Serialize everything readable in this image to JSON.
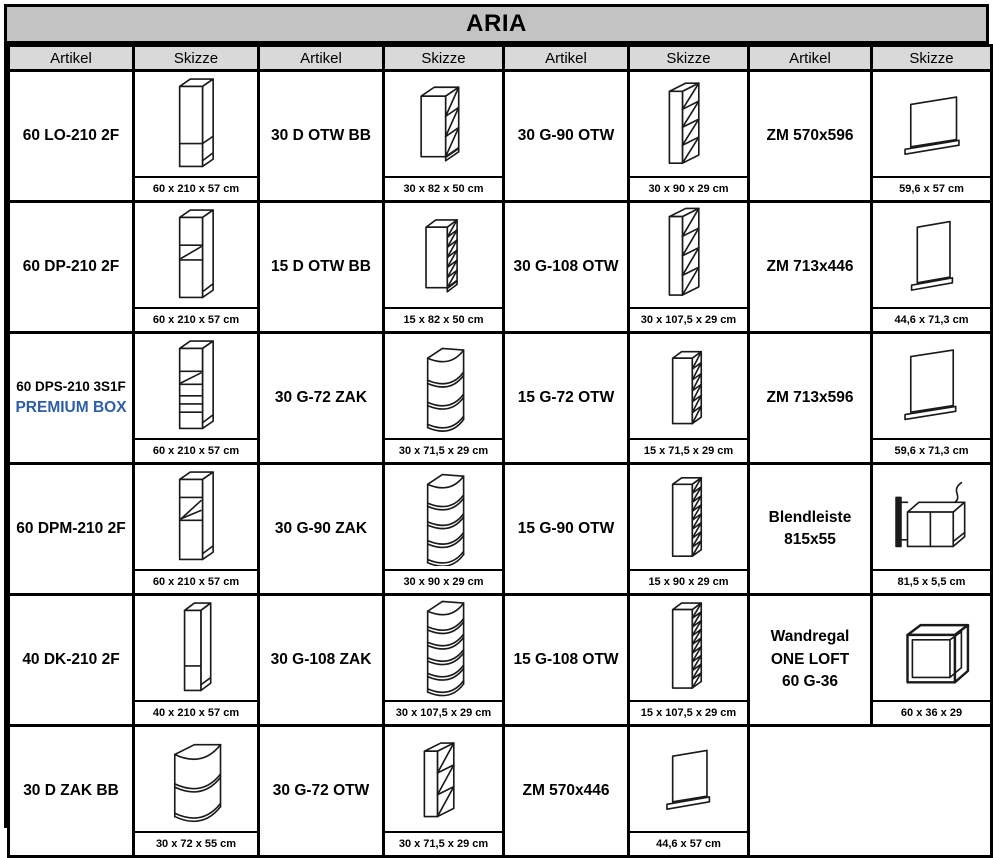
{
  "title": "ARIA",
  "column_headers": [
    "Artikel",
    "Skizze",
    "Artikel",
    "Skizze",
    "Artikel",
    "Skizze",
    "Artikel",
    "Skizze"
  ],
  "colors": {
    "title_bg": "#C3C3C3",
    "subheader_bg": "#D9D9D9",
    "border": "#000000",
    "premium_blue": "#2E5EA6"
  },
  "rows": [
    [
      {
        "artikel_lines": [
          "60 LO-210 2F"
        ],
        "sketch": "tall-cabinet-2f",
        "dim": "60 x 210 x 57 cm"
      },
      {
        "artikel_lines": [
          "30 D OTW BB"
        ],
        "sketch": "base-open-shelf-30",
        "dim": "30 x 82 x 50 cm"
      },
      {
        "artikel_lines": [
          "30 G-90 OTW"
        ],
        "sketch": "wall-open-shelf-30-90",
        "dim": "30 x 90 x 29 cm"
      },
      {
        "artikel_lines": [
          "ZM 570x596"
        ],
        "sketch": "side-panel-570x596",
        "dim": "59,6 x 57 cm"
      }
    ],
    [
      {
        "artikel_lines": [
          "60 DP-210 2F"
        ],
        "sketch": "tall-oven-cabinet",
        "dim": "60 x 210 x 57 cm"
      },
      {
        "artikel_lines": [
          "15 D OTW BB"
        ],
        "sketch": "base-open-shelf-15",
        "dim": "15 x 82 x 50 cm"
      },
      {
        "artikel_lines": [
          "30 G-108 OTW"
        ],
        "sketch": "wall-open-shelf-30-108",
        "dim": "30 x 107,5 x 29 cm"
      },
      {
        "artikel_lines": [
          "ZM 713x446"
        ],
        "sketch": "side-panel-713x446",
        "dim": "44,6 x 71,3 cm"
      }
    ],
    [
      {
        "artikel_lines": [
          "60 DPS-210 3S1F",
          "PREMIUM BOX"
        ],
        "premium_line": 1,
        "sketch": "tall-oven-drawer-cabinet",
        "dim": "60 x 210 x 57 cm"
      },
      {
        "artikel_lines": [
          "30 G-72 ZAK"
        ],
        "sketch": "wall-corner-shelf-72",
        "dim": "30 x 71,5 x 29 cm"
      },
      {
        "artikel_lines": [
          "15 G-72 OTW"
        ],
        "sketch": "wall-open-shelf-15-72",
        "dim": "15 x 71,5 x 29 cm"
      },
      {
        "artikel_lines": [
          "ZM 713x596"
        ],
        "sketch": "side-panel-713x596",
        "dim": "59,6 x 71,3 cm"
      }
    ],
    [
      {
        "artikel_lines": [
          "60 DPM-210 2F"
        ],
        "sketch": "tall-microwave-cabinet",
        "dim": "60 x 210 x 57 cm"
      },
      {
        "artikel_lines": [
          "30 G-90 ZAK"
        ],
        "sketch": "wall-corner-shelf-90",
        "dim": "30 x 90 x 29 cm"
      },
      {
        "artikel_lines": [
          "15 G-90 OTW"
        ],
        "sketch": "wall-open-shelf-15-90",
        "dim": "15 x 90 x 29 cm"
      },
      {
        "artikel_lines": [
          "Blendleiste",
          "815x55"
        ],
        "sketch": "blende-strip",
        "dim": "81,5 x 5,5 cm"
      }
    ],
    [
      {
        "artikel_lines": [
          "40 DK-210 2F"
        ],
        "sketch": "tall-narrow-cabinet-2f",
        "dim": "40 x 210 x 57 cm"
      },
      {
        "artikel_lines": [
          "30 G-108 ZAK"
        ],
        "sketch": "wall-corner-shelf-108",
        "dim": "30 x 107,5 x 29 cm"
      },
      {
        "artikel_lines": [
          "15 G-108 OTW"
        ],
        "sketch": "wall-open-shelf-15-108",
        "dim": "15 x 107,5 x 29 cm"
      },
      {
        "artikel_lines": [
          "Wandregal",
          "ONE LOFT",
          "60 G-36"
        ],
        "sketch": "wall-frame-shelf",
        "dim": "60 x 36 x 29"
      }
    ],
    [
      {
        "artikel_lines": [
          "30 D ZAK BB"
        ],
        "sketch": "base-corner-shelf",
        "dim": "30 x 72 x 55 cm"
      },
      {
        "artikel_lines": [
          "30 G-72 OTW"
        ],
        "sketch": "wall-open-shelf-30-72",
        "dim": "30 x 71,5 x 29 cm"
      },
      {
        "artikel_lines": [
          "ZM 570x446"
        ],
        "sketch": "side-panel-570x446",
        "dim": "44,6 x 57 cm"
      },
      {
        "empty": true
      }
    ]
  ]
}
